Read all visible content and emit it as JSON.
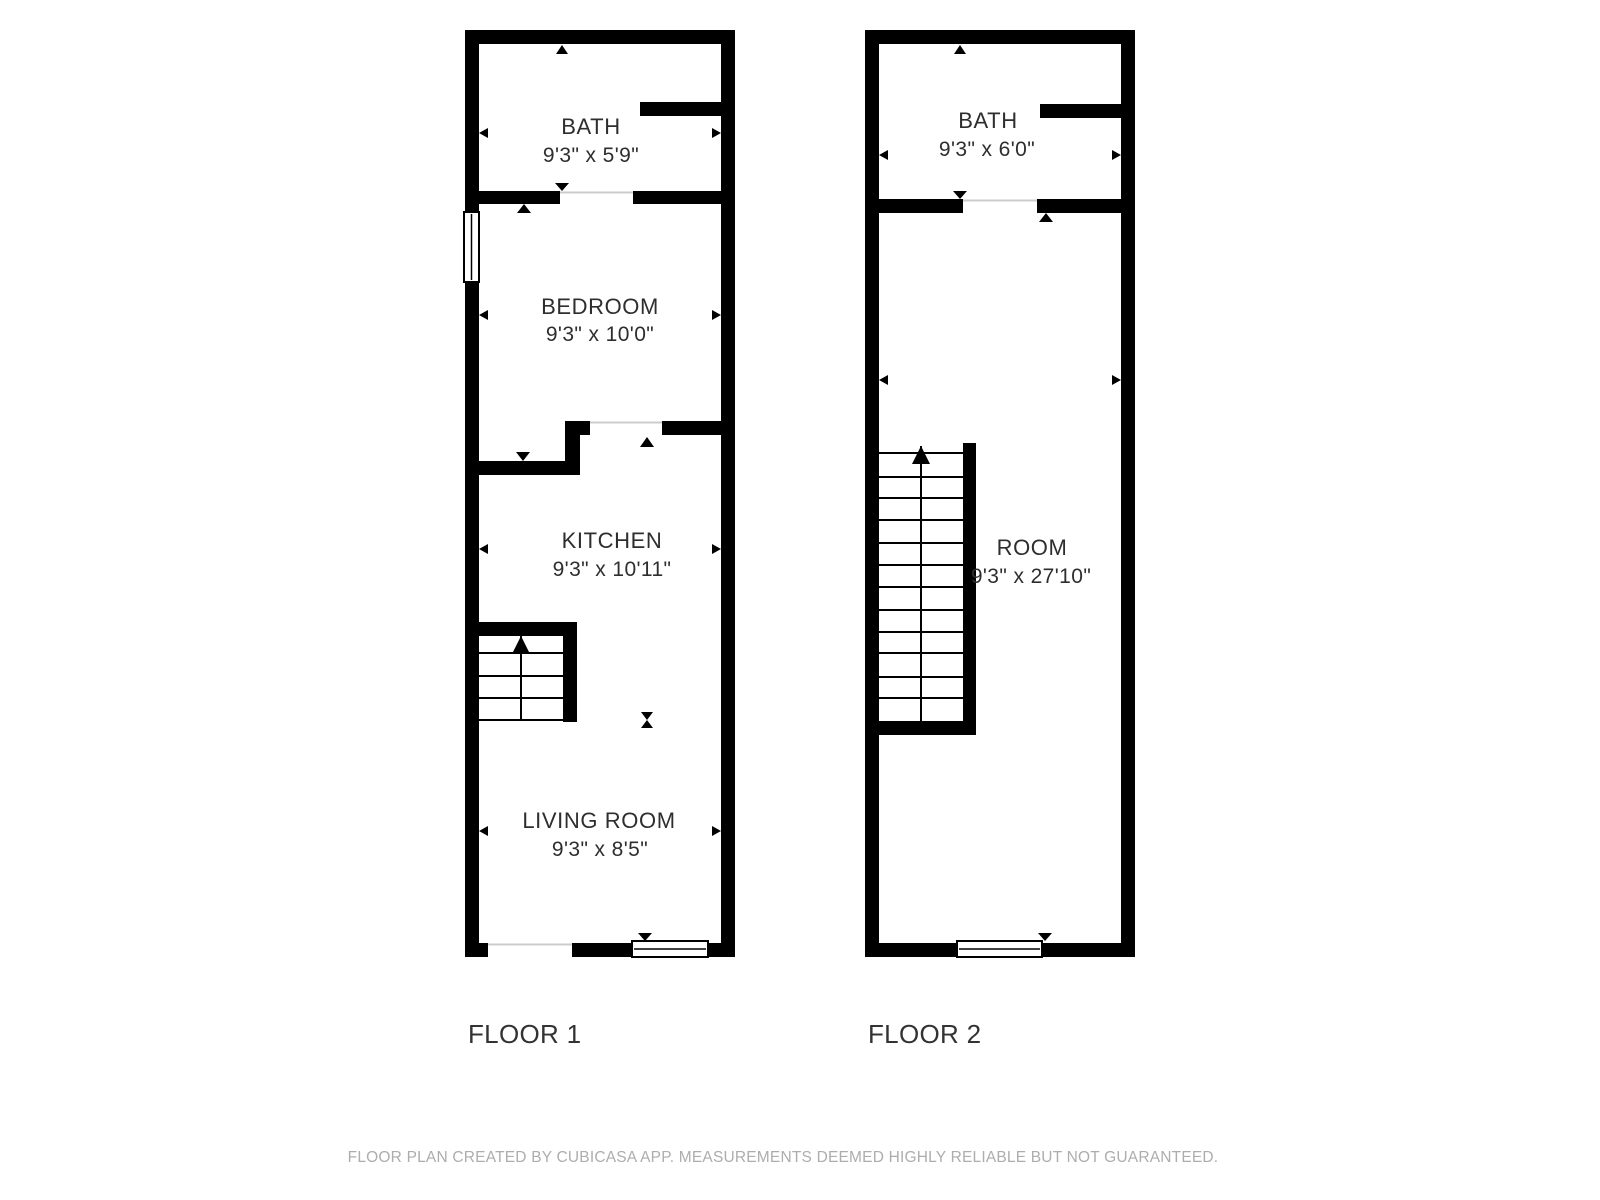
{
  "floor1": {
    "label": "FLOOR 1",
    "bath": {
      "name": "BATH",
      "dims": "9'3\" x 5'9\""
    },
    "bedroom": {
      "name": "BEDROOM",
      "dims": "9'3\" x 10'0\""
    },
    "kitchen": {
      "name": "KITCHEN",
      "dims": "9'3\" x 10'11\""
    },
    "living": {
      "name": "LIVING ROOM",
      "dims": "9'3\" x 8'5\""
    }
  },
  "floor2": {
    "label": "FLOOR 2",
    "bath": {
      "name": "BATH",
      "dims": "9'3\" x 6'0\""
    },
    "room": {
      "name": "ROOM",
      "dims": "9'3\" x 27'10\""
    }
  },
  "footer": {
    "note": "FLOOR PLAN CREATED BY CUBICASA APP. MEASUREMENTS DEEMED HIGHLY RELIABLE BUT NOT GUARANTEED."
  },
  "colors": {
    "wall": "#000000",
    "room_text": "#2e2e2e",
    "floor_label_text": "#333333",
    "footer_text": "#adadad",
    "door_opening_line": "#cccccc"
  }
}
